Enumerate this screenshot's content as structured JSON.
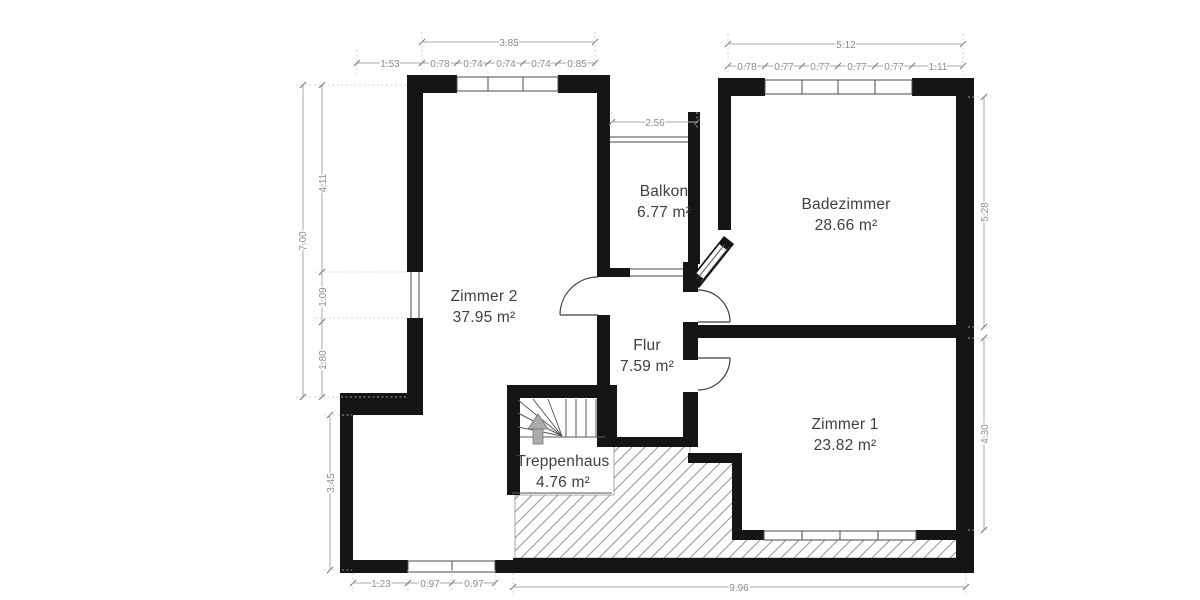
{
  "plan": {
    "rooms": [
      {
        "name": "Zimmer 2",
        "area": "37.95 m²"
      },
      {
        "name": "Balkon",
        "area": "6.77 m²"
      },
      {
        "name": "Badezimmer",
        "area": "28.66 m²"
      },
      {
        "name": "Flur",
        "area": "7.59 m²"
      },
      {
        "name": "Zimmer 1",
        "area": "23.82 m²"
      },
      {
        "name": "Treppenhaus",
        "area": "4.76 m²"
      }
    ],
    "dimensions": {
      "top_left_total": "3.85",
      "top_left_offset": "1.53",
      "top_left_segments": [
        "0.78",
        "0.74",
        "0.74",
        "0.74",
        "0.85"
      ],
      "top_right_total": "5.12",
      "top_right_segments": [
        "0.78",
        "0.77",
        "0.77",
        "0.77",
        "0.77",
        "1.11"
      ],
      "balkon_width": "2.56",
      "left_total": "7.00",
      "left_segments": [
        "4.11",
        "1.09",
        "1.80"
      ],
      "left_lower": "3.45",
      "right_upper": "5.28",
      "right_lower": "4.30",
      "bottom_left_segments": [
        "1.23",
        "0.97",
        "0.97"
      ],
      "bottom_total": "9.96"
    },
    "icons": {
      "stairs_direction": "up-arrow"
    },
    "colors": {
      "wall": "#151515",
      "dimension_text": "#8c8c8c",
      "label_text": "#3f3f3f",
      "hatch": "#9a9a9a",
      "arrow": "#ababab"
    }
  }
}
